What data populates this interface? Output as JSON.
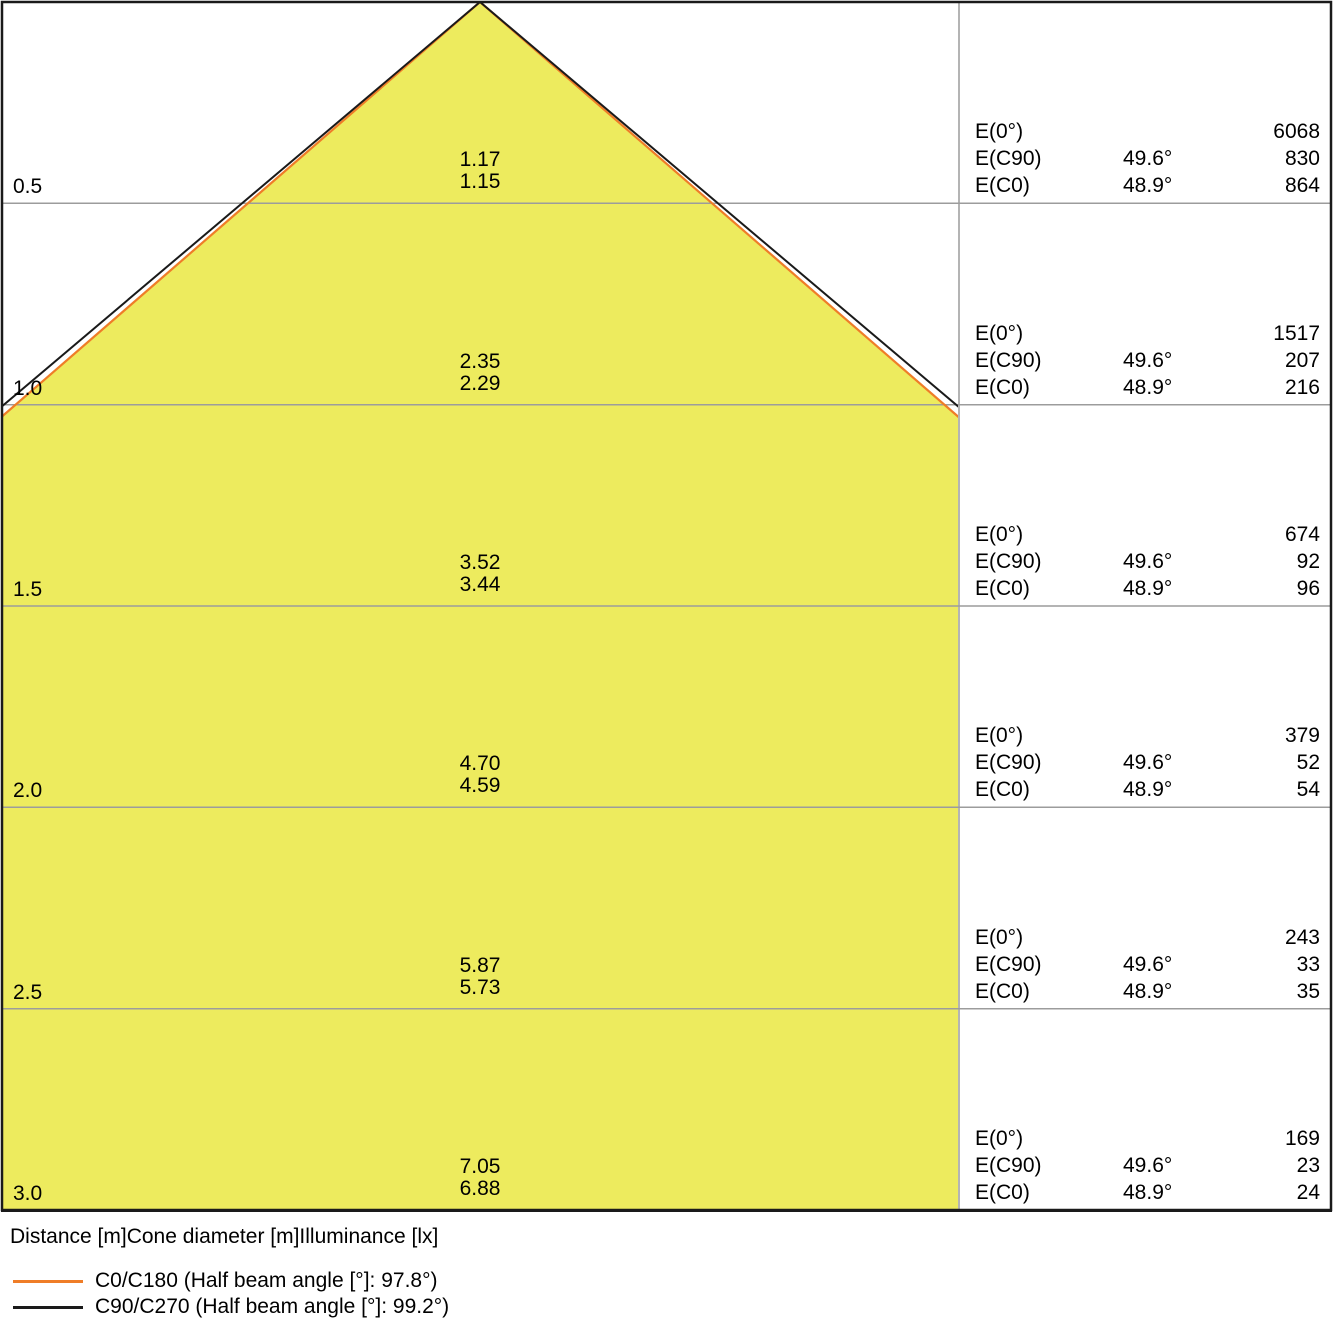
{
  "chart_data": {
    "type": "area",
    "description": "Photometric light cone diagram: beam diameter and illuminance vs distance",
    "x": [
      0.5,
      1.0,
      1.5,
      2.0,
      2.5,
      3.0
    ],
    "x_unit": "m",
    "xlabel": "Distance [m]Cone diameter [m]Illuminance [lx]",
    "ylim": [
      0,
      3.0
    ],
    "grid": true,
    "legend_position": "bottom-left",
    "series": [
      {
        "name": "C0/C180 (Half beam angle [°]: 97.8°)",
        "color": "#ef7d28",
        "half_beam_angle_deg": 48.9,
        "cone_diameter_m": [
          1.15,
          2.29,
          3.44,
          4.59,
          5.73,
          6.88
        ],
        "illuminance_lx": [
          864,
          216,
          96,
          54,
          35,
          24
        ]
      },
      {
        "name": "C90/C270 (Half beam angle [°]: 99.2°)",
        "color": "#1a1a1a",
        "half_beam_angle_deg": 49.6,
        "cone_diameter_m": [
          1.17,
          2.35,
          3.52,
          4.7,
          5.87,
          7.05
        ],
        "illuminance_lx": [
          830,
          207,
          92,
          52,
          33,
          23
        ]
      }
    ],
    "e0_illuminance_lx": [
      6068,
      1517,
      674,
      379,
      243,
      169
    ]
  },
  "colors": {
    "cone_fill": "#edeb5e",
    "c0_line": "#ef7d28",
    "c90_line": "#1a1a1a",
    "gridline": "#9c9c9c",
    "border": "#1a1a1a"
  },
  "table": {
    "e0_label": "E(0°)",
    "c90_label": "E(C90)",
    "c0_label": "E(C0)"
  },
  "levels": [
    {
      "distance": "0.5",
      "diam_c90": "1.17",
      "diam_c0": "1.15",
      "e0": "6068",
      "c90_angle": "49.6°",
      "c90": "830",
      "c0_angle": "48.9°",
      "c0": "864"
    },
    {
      "distance": "1.0",
      "diam_c90": "2.35",
      "diam_c0": "2.29",
      "e0": "1517",
      "c90_angle": "49.6°",
      "c90": "207",
      "c0_angle": "48.9°",
      "c0": "216"
    },
    {
      "distance": "1.5",
      "diam_c90": "3.52",
      "diam_c0": "3.44",
      "e0": "674",
      "c90_angle": "49.6°",
      "c90": "92",
      "c0_angle": "48.9°",
      "c0": "96"
    },
    {
      "distance": "2.0",
      "diam_c90": "4.70",
      "diam_c0": "4.59",
      "e0": "379",
      "c90_angle": "49.6°",
      "c90": "52",
      "c0_angle": "48.9°",
      "c0": "54"
    },
    {
      "distance": "2.5",
      "diam_c90": "5.87",
      "diam_c0": "5.73",
      "e0": "243",
      "c90_angle": "49.6°",
      "c90": "33",
      "c0_angle": "48.9°",
      "c0": "35"
    },
    {
      "distance": "3.0",
      "diam_c90": "7.05",
      "diam_c0": "6.88",
      "e0": "169",
      "c90_angle": "49.6°",
      "c90": "23",
      "c0_angle": "48.9°",
      "c0": "24"
    }
  ],
  "footer": {
    "caption": "Distance [m]Cone diameter [m]Illuminance [lx]",
    "legend": [
      {
        "label": "C0/C180 (Half beam angle [°]: 97.8°)",
        "color": "#ef7d28"
      },
      {
        "label": "C90/C270 (Half beam angle [°]: 99.2°)",
        "color": "#1a1a1a"
      }
    ]
  }
}
